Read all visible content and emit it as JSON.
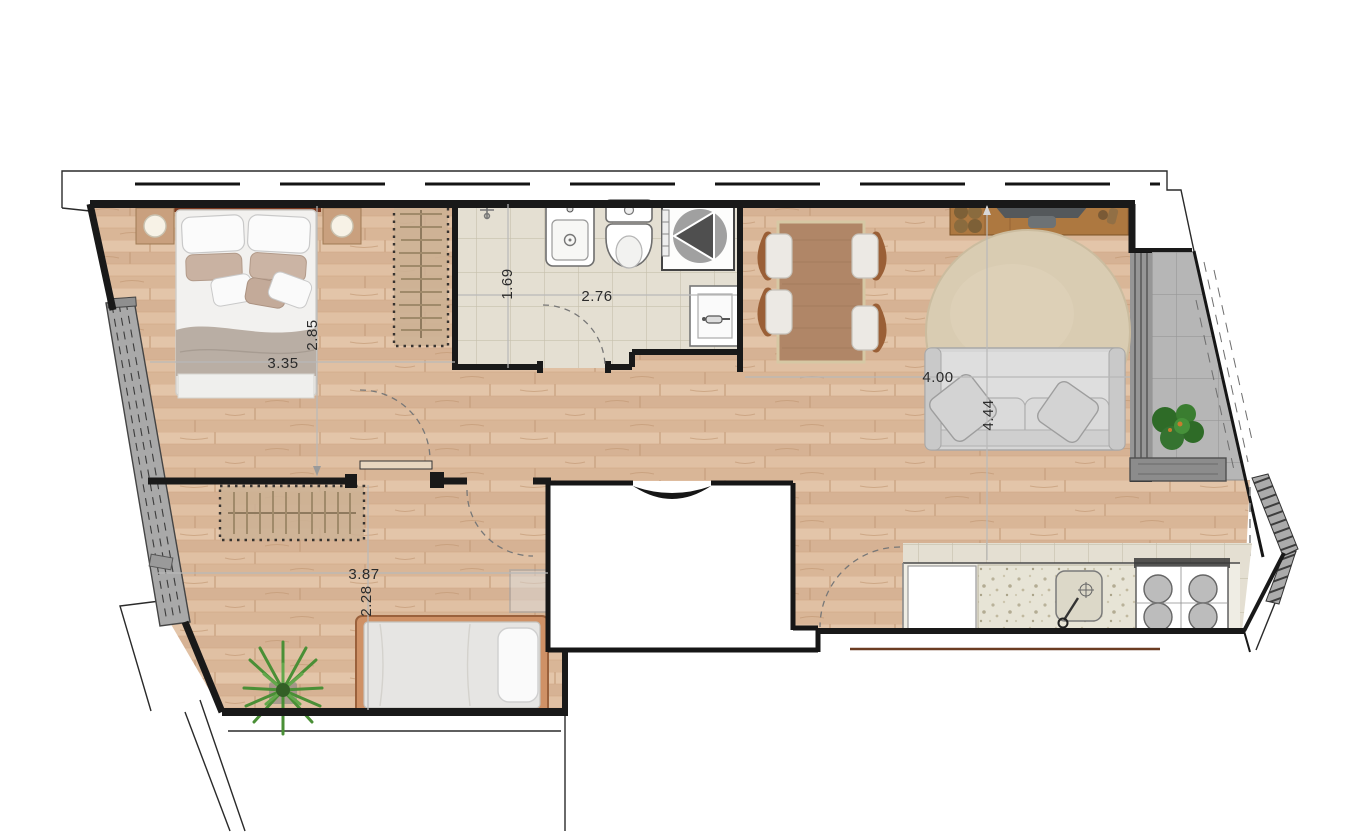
{
  "plan": {
    "type": "apartment-floor-plan",
    "dims": {
      "bedroom1_w": "3.35",
      "bedroom1_d": "2.85",
      "bath_d": "1.69",
      "bath_w": "2.76",
      "living_w": "4.00",
      "living_d": "4.44",
      "bedroom2_w": "3.87",
      "bedroom2_d": "2.28"
    },
    "rooms": [
      {
        "name": "bedroom-1",
        "furniture": [
          "double-bed",
          "nightstand-left",
          "nightstand-right",
          "wardrobe"
        ]
      },
      {
        "name": "bathroom",
        "furniture": [
          "vanity-sink",
          "toilet",
          "shower",
          "washbasin"
        ]
      },
      {
        "name": "living-dining-room",
        "furniture": [
          "dining-table",
          "four-chairs",
          "tv-sideboard",
          "round-rug",
          "sofa"
        ]
      },
      {
        "name": "bedroom-2",
        "furniture": [
          "single-bed",
          "wardrobe",
          "plant"
        ]
      },
      {
        "name": "kitchen",
        "furniture": [
          "counter",
          "kitchen-sink",
          "cooktop",
          "appliance"
        ]
      },
      {
        "name": "balcony-right",
        "furniture": [
          "plant",
          "planter"
        ]
      },
      {
        "name": "balcony-left",
        "furniture": []
      },
      {
        "name": "hallway",
        "furniture": []
      },
      {
        "name": "stair-core",
        "furniture": [
          "entry-door"
        ]
      }
    ],
    "colors": {
      "wood_floor": "#dcbb9e",
      "tile_floor": "#e4dfd2",
      "balcony_gray": "#b6b6b6",
      "wall": "#1a1a1a",
      "dimension_text": "#2b2b2b",
      "table_wood": "#b08667",
      "rug": "#d9ccb2",
      "sofa": "#d6d6d6",
      "headboard": "#7c3a20"
    }
  }
}
